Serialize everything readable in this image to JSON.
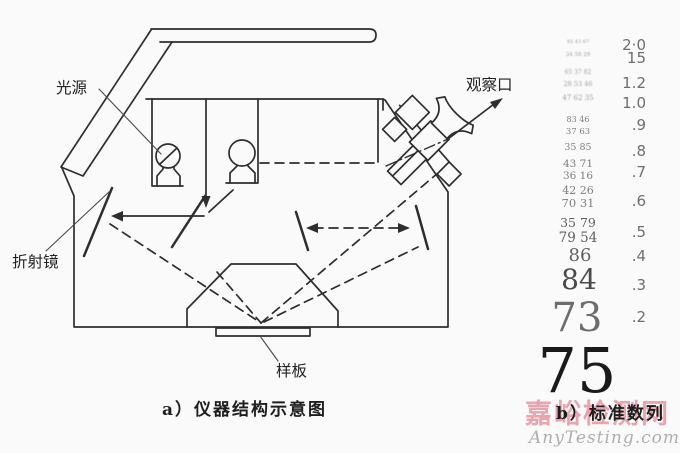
{
  "figure": {
    "background": "#fafafa",
    "ink_color": "#2e2e2e",
    "panel_a": {
      "caption": "a）仪器结构示意图",
      "labels": {
        "light_source": "光源",
        "observation_port": "观察口",
        "refraction_mirror": "折射镜",
        "sample_plate": "样板"
      }
    },
    "panel_b": {
      "caption": "b）标准数列",
      "numeral_rows": [
        "85 43 67",
        "34 58 29",
        "65 37 82",
        "28 53 46",
        "47 62 35",
        "83 46",
        "37 63",
        "35 85",
        "43 71",
        "36 16",
        "42 26",
        "70 31",
        "35 79",
        "79 54",
        "86",
        "84",
        "73",
        "75"
      ],
      "scale_values": [
        "2·0",
        "15",
        "1.2",
        "1.0",
        ".9",
        ".8",
        ".7",
        ".6",
        ".5",
        ".4",
        ".3",
        ".2"
      ]
    },
    "watermark": {
      "site_name": "嘉峪检测网",
      "site_domain": "AnyTesting.com",
      "pink": "#e3808f",
      "gray": "#a6a6a6"
    }
  }
}
